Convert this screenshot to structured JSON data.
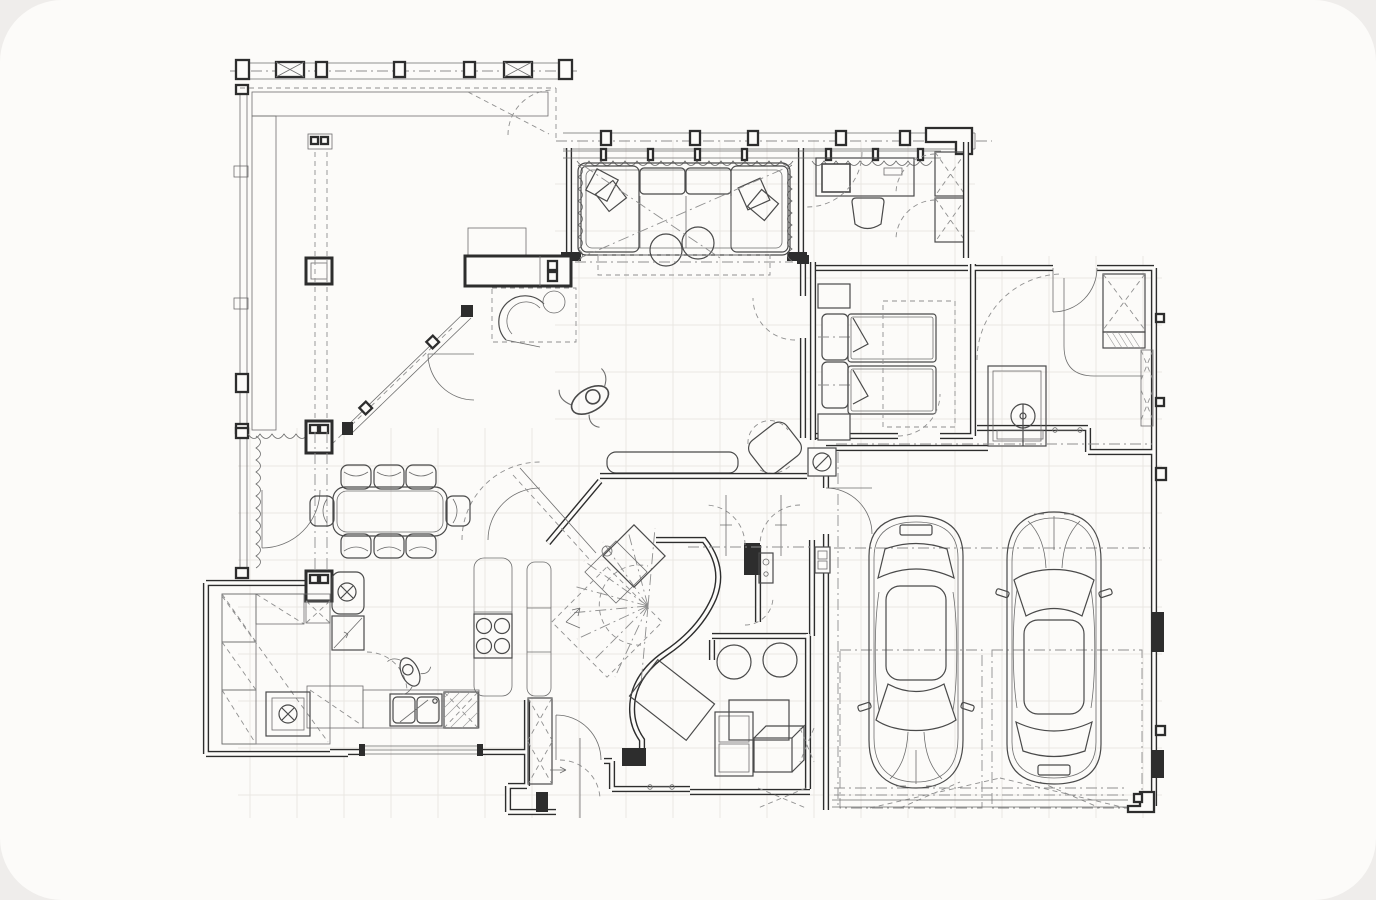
{
  "canvas": {
    "width": 1376,
    "height": 900,
    "corner_radius": 62
  },
  "palette": {
    "background": "#efedeb",
    "surface": "#fcfbf9",
    "wall": "#2d2d2d",
    "furniture": "#4a4a4a",
    "thin": "#6e6e6e",
    "dashed": "#8f8f8f",
    "grid": "#eae7e3",
    "hatch": "#9a9a9a"
  },
  "drawing": {
    "type": "architectural-floor-plan",
    "view": "top-down CAD line drawing",
    "text_labels": [],
    "rooms": [
      {
        "name": "terrace-deck"
      },
      {
        "name": "living-room"
      },
      {
        "name": "study"
      },
      {
        "name": "bedroom"
      },
      {
        "name": "laundry-utility-room"
      },
      {
        "name": "garage"
      },
      {
        "name": "dining-area"
      },
      {
        "name": "kitchen"
      },
      {
        "name": "pantry"
      },
      {
        "name": "entry-hall"
      },
      {
        "name": "stair-hall"
      },
      {
        "name": "storage-room"
      }
    ],
    "furniture": [
      {
        "name": "pergola-beams",
        "room": "terrace-deck"
      },
      {
        "name": "deck-planking",
        "room": "terrace-deck"
      },
      {
        "name": "fireplace",
        "room": "living-room"
      },
      {
        "name": "sectional-sofa",
        "room": "living-room"
      },
      {
        "name": "round-ottomans",
        "room": "living-room"
      },
      {
        "name": "bench",
        "room": "living-room"
      },
      {
        "name": "lounge-chair",
        "room": "living-room"
      },
      {
        "name": "desk-with-monitor",
        "room": "study"
      },
      {
        "name": "desk-chair",
        "room": "study"
      },
      {
        "name": "wardrobe",
        "room": "study"
      },
      {
        "name": "double-bed",
        "room": "bedroom"
      },
      {
        "name": "nightstands",
        "room": "bedroom"
      },
      {
        "name": "laundry-sink",
        "room": "laundry-utility-room"
      },
      {
        "name": "built-in-closet",
        "room": "laundry-utility-room"
      },
      {
        "name": "dining-table",
        "room": "dining-area"
      },
      {
        "name": "dining-chairs",
        "room": "dining-area"
      },
      {
        "name": "refrigerator",
        "room": "kitchen"
      },
      {
        "name": "cooktop",
        "room": "kitchen"
      },
      {
        "name": "double-sink",
        "room": "kitchen"
      },
      {
        "name": "dishwasher",
        "room": "kitchen"
      },
      {
        "name": "pantry-shelving",
        "room": "pantry"
      },
      {
        "name": "spiral-staircase",
        "room": "stair-hall"
      },
      {
        "name": "storage-boxes",
        "room": "storage-room"
      },
      {
        "name": "round-stools",
        "room": "storage-room"
      },
      {
        "name": "car-left",
        "room": "garage"
      },
      {
        "name": "car-right",
        "room": "garage"
      },
      {
        "name": "gas-meter",
        "room": "stair-hall"
      }
    ],
    "counts": {
      "dining_chairs": 8,
      "cooktop_burners": 4,
      "cars": 2,
      "round_ottomans": 2,
      "round_stools": 2,
      "people_figures": 2,
      "pergola_posts": 7,
      "stair_radial_treads": 10
    }
  }
}
